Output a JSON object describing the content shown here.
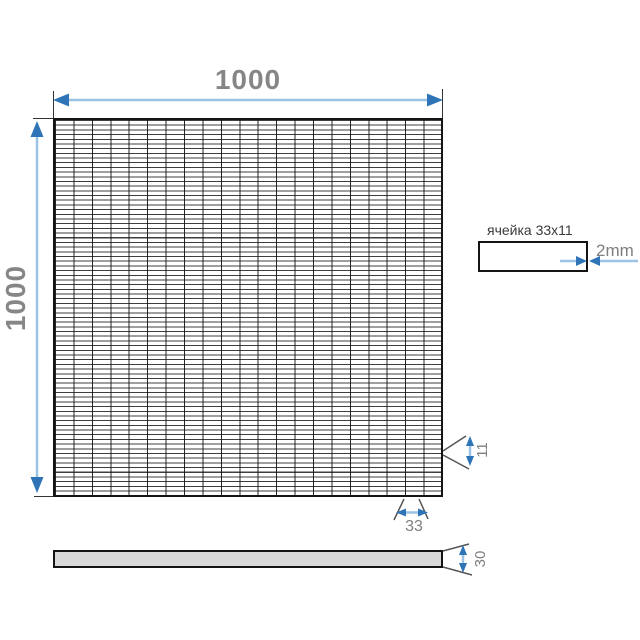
{
  "diagram": {
    "dimensions": {
      "width": "1000",
      "height": "1000",
      "cell_width": "33",
      "cell_height": "11",
      "thickness": "30"
    },
    "cell_detail": {
      "label": "ячейка 33x11",
      "wire_diameter": "2mm"
    },
    "colors": {
      "dimension_arrow": "#2e74b6",
      "dimension_line": "#9cc2e6",
      "leader_line": "#555555",
      "dimension_text": "#7f7f7f",
      "cell_label_text": "#3a3a3a",
      "grid_line": "#141414",
      "bar_fill": "#d9d9d9"
    }
  }
}
